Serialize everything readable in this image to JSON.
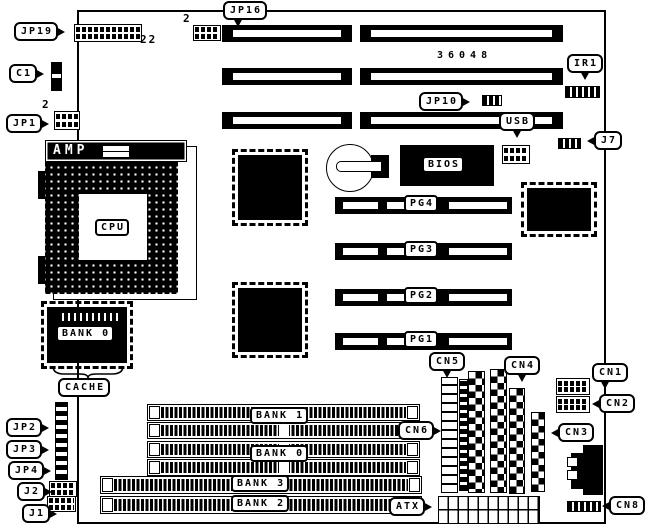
{
  "board": {
    "model_number": "36048",
    "brand": "AMP",
    "colors": {
      "line": "#000000",
      "background": "#ffffff"
    }
  },
  "callouts": {
    "jp19": "JP19",
    "c1": "C1",
    "jp1": "JP1",
    "jp16": "JP16",
    "jp10": "JP10",
    "ir1": "IR1",
    "usb": "USB",
    "j7": "J7",
    "jp2": "JP2",
    "jp3": "JP3",
    "jp4": "JP4",
    "j2": "J2",
    "j1": "J1",
    "cn1": "CN1",
    "cn2": "CN2",
    "cn3": "CN3",
    "cn4": "CN4",
    "cn5": "CN5",
    "cn6": "CN6",
    "cn8": "CN8",
    "atx": "ATX",
    "cache": "CACHE"
  },
  "chips": {
    "cpu": "CPU",
    "bios": "BIOS",
    "cache_bank": "BANK 0"
  },
  "memory_banks": {
    "bank1": "BANK 1",
    "bank0": "BANK 0",
    "bank3": "BANK 3",
    "bank2": "BANK 2"
  },
  "slots": {
    "pg4": "PG4",
    "pg3": "PG3",
    "pg2": "PG2",
    "pg1": "PG1"
  },
  "pin_numbers": {
    "jp19": "22",
    "jp16": "2",
    "jp1": "2"
  }
}
